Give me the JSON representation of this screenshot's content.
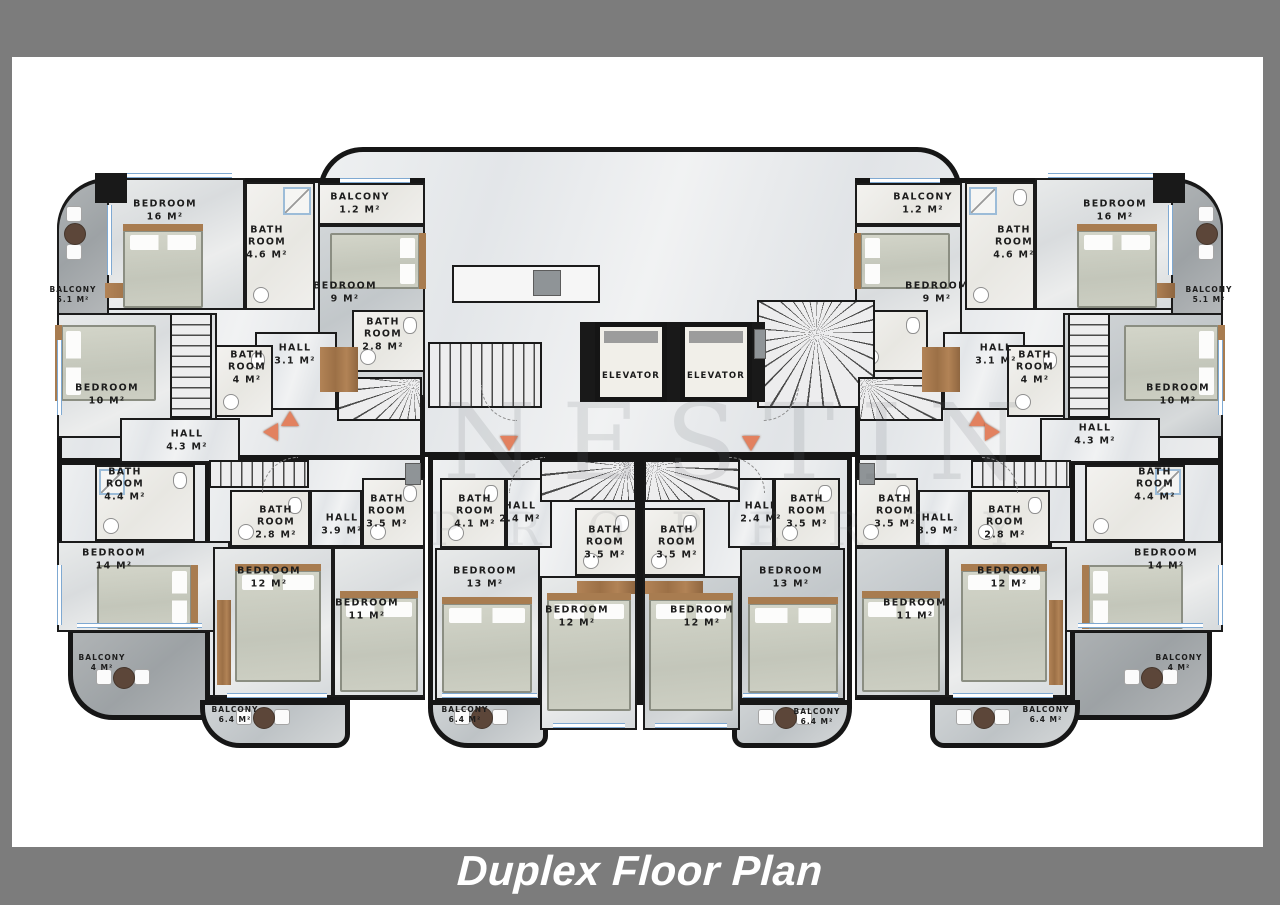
{
  "frame": {
    "title": "Duplex Floor Plan"
  },
  "watermark": {
    "line1": "NESTIN",
    "line2": "PROPERTY"
  },
  "lobby": {
    "elevator1": "ELEVATOR",
    "elevator2": "ELEVATOR"
  },
  "rooms": [
    {
      "name": "BEDROOM",
      "area": "16 M²"
    },
    {
      "name": "BATH ROOM",
      "area": "4.6 M²"
    },
    {
      "name": "BALCONY",
      "area": "1.2 M²"
    },
    {
      "name": "BEDROOM",
      "area": "9 M²"
    },
    {
      "name": "BATH ROOM",
      "area": "2.8 M²"
    },
    {
      "name": "HALL",
      "area": "3.1 M²"
    },
    {
      "name": "BALCONY",
      "area": "5.1 M²"
    },
    {
      "name": "BEDROOM",
      "area": "10 M²"
    },
    {
      "name": "BATH ROOM",
      "area": "4 M²"
    },
    {
      "name": "HALL",
      "area": "4.3 M²"
    },
    {
      "name": "BATH ROOM",
      "area": "4.4 M²"
    },
    {
      "name": "BEDROOM",
      "area": "14 M²"
    },
    {
      "name": "BALCONY",
      "area": "4 M²"
    },
    {
      "name": "BATH ROOM",
      "area": "2.8 M²"
    },
    {
      "name": "HALL",
      "area": "3.9 M²"
    },
    {
      "name": "BATH ROOM",
      "area": "3.5 M²"
    },
    {
      "name": "BEDROOM",
      "area": "12 M²"
    },
    {
      "name": "BEDROOM",
      "area": "11 M²"
    },
    {
      "name": "BALCONY",
      "area": "6.4 M²"
    },
    {
      "name": "BATH ROOM",
      "area": "4.1 M²"
    },
    {
      "name": "HALL",
      "area": "2.4 M²"
    },
    {
      "name": "BATH ROOM",
      "area": "3.5 M²"
    },
    {
      "name": "BEDROOM",
      "area": "13 M²"
    },
    {
      "name": "BEDROOM",
      "area": "12 M²"
    },
    {
      "name": "BALCONY",
      "area": "6.4 M²"
    },
    {
      "name": "BATH ROOM",
      "area": "3.5 M²"
    },
    {
      "name": "HALL",
      "area": "2.4 M²"
    },
    {
      "name": "BATH ROOM",
      "area": "3.5 M²"
    },
    {
      "name": "BEDROOM",
      "area": "12 M²"
    },
    {
      "name": "BEDROOM",
      "area": "13 M²"
    },
    {
      "name": "BALCONY",
      "area": "6.4 M²"
    },
    {
      "name": "BATH ROOM",
      "area": "3.5 M²"
    },
    {
      "name": "HALL",
      "area": "3.9 M²"
    },
    {
      "name": "BATH ROOM",
      "area": "2.8 M²"
    },
    {
      "name": "BEDROOM",
      "area": "11 M²"
    },
    {
      "name": "BEDROOM",
      "area": "12 M²"
    },
    {
      "name": "BALCONY",
      "area": "6.4 M²"
    },
    {
      "name": "BATH ROOM",
      "area": "4.4 M²"
    },
    {
      "name": "BEDROOM",
      "area": "14 M²"
    },
    {
      "name": "BALCONY",
      "area": "4 M²"
    },
    {
      "name": "BALCONY",
      "area": "1.2 M²"
    },
    {
      "name": "BATH ROOM",
      "area": "4.6 M²"
    },
    {
      "name": "BEDROOM",
      "area": "16 M²"
    },
    {
      "name": "BEDROOM",
      "area": "9 M²"
    },
    {
      "name": "BALCONY",
      "area": "5.1 M²"
    },
    {
      "name": "HALL",
      "area": "3.1 M²"
    },
    {
      "name": "BATH ROOM",
      "area": "4 M²"
    },
    {
      "name": "BEDROOM",
      "area": "10 M²"
    },
    {
      "name": "HALL",
      "area": "4.3 M²"
    }
  ]
}
